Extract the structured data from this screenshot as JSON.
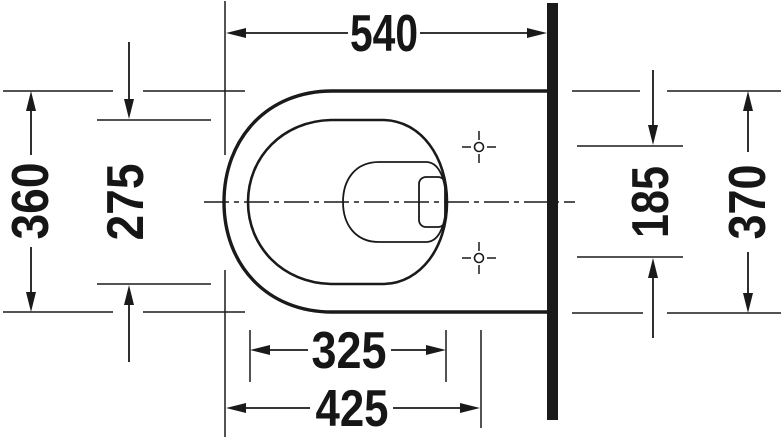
{
  "drawing": {
    "background": "#ffffff",
    "line_color": "#1a1a1a",
    "dimensions": {
      "top": "540",
      "left_outer": "360",
      "left_inner": "275",
      "right_inner": "185",
      "right_outer": "370",
      "bottom_inner": "325",
      "bottom_outer": "425"
    }
  }
}
